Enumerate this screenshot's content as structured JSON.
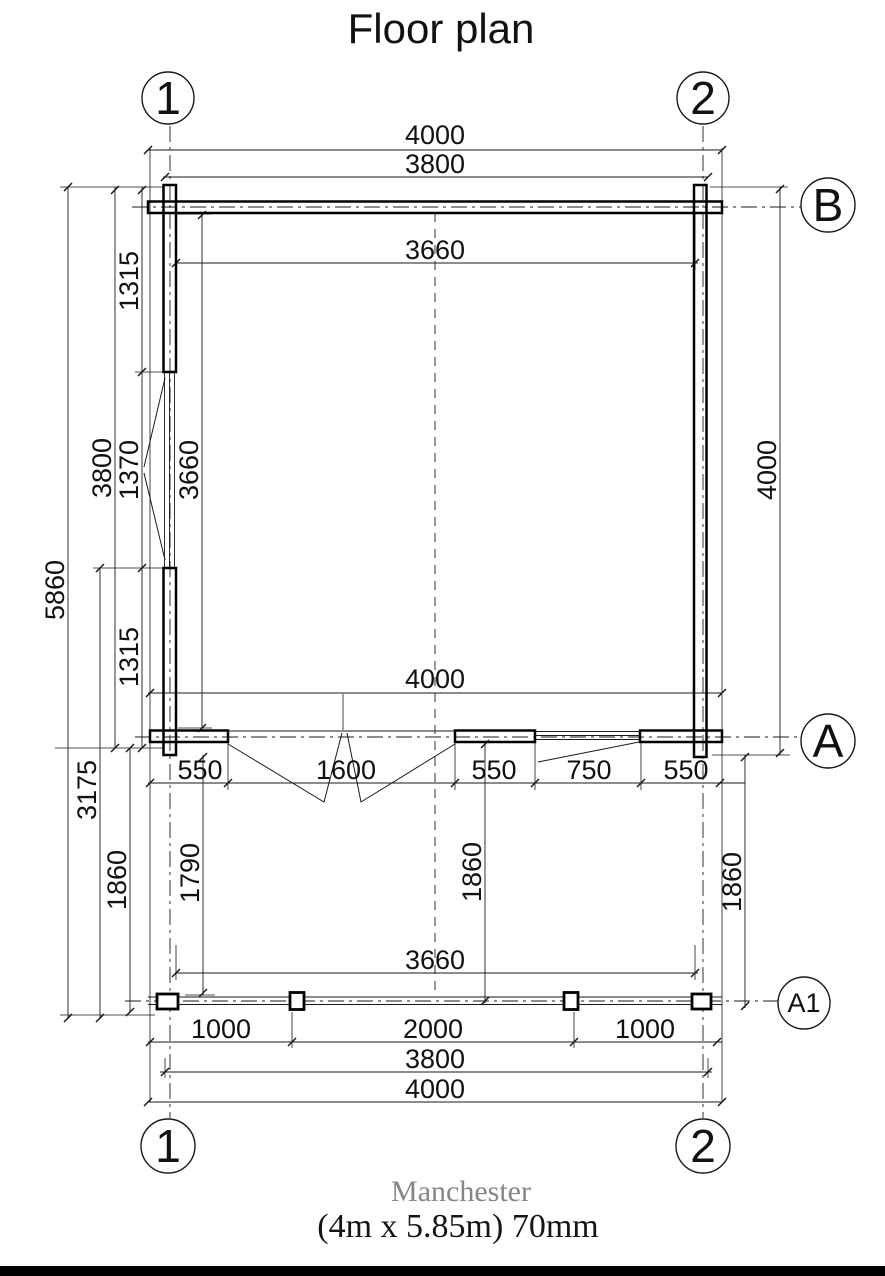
{
  "title": "Floor plan",
  "footer": {
    "model_name": "Manchester",
    "model_specs": "(4m x 5.85m) 70mm"
  },
  "colors": {
    "line": "#1a1a1a",
    "model_name_gray": "#868686",
    "background": "#ffffff",
    "footer_bar": "#000000"
  },
  "grid": {
    "top_left": "1",
    "top_right": "2",
    "bottom_left": "1",
    "bottom_right": "2",
    "row_b": "B",
    "row_a": "A",
    "row_a1": "A1"
  },
  "dims": {
    "top_overall": "4000",
    "top_axes": "3800",
    "top_inner": "3660",
    "mid_overall": "4000",
    "porch_chain_550a": "550",
    "porch_chain_1600": "1600",
    "porch_chain_550b": "550",
    "porch_chain_750": "750",
    "porch_chain_550c": "550",
    "bottom_inner": "3660",
    "bottom_1000a": "1000",
    "bottom_2000": "2000",
    "bottom_1000b": "1000",
    "bottom_axes": "3800",
    "bottom_overall": "4000",
    "left_overall": "5860",
    "left_room": "3800",
    "left_porch": "3175",
    "left_porch_depth": "1860",
    "left_seg_top": "1315",
    "left_window": "1370",
    "left_seg_bottom": "1315",
    "inner_left_height": "3660",
    "porch_left_inner": "1790",
    "porch_center_depth": "1860",
    "porch_right_depth": "1860",
    "right_room": "4000"
  }
}
